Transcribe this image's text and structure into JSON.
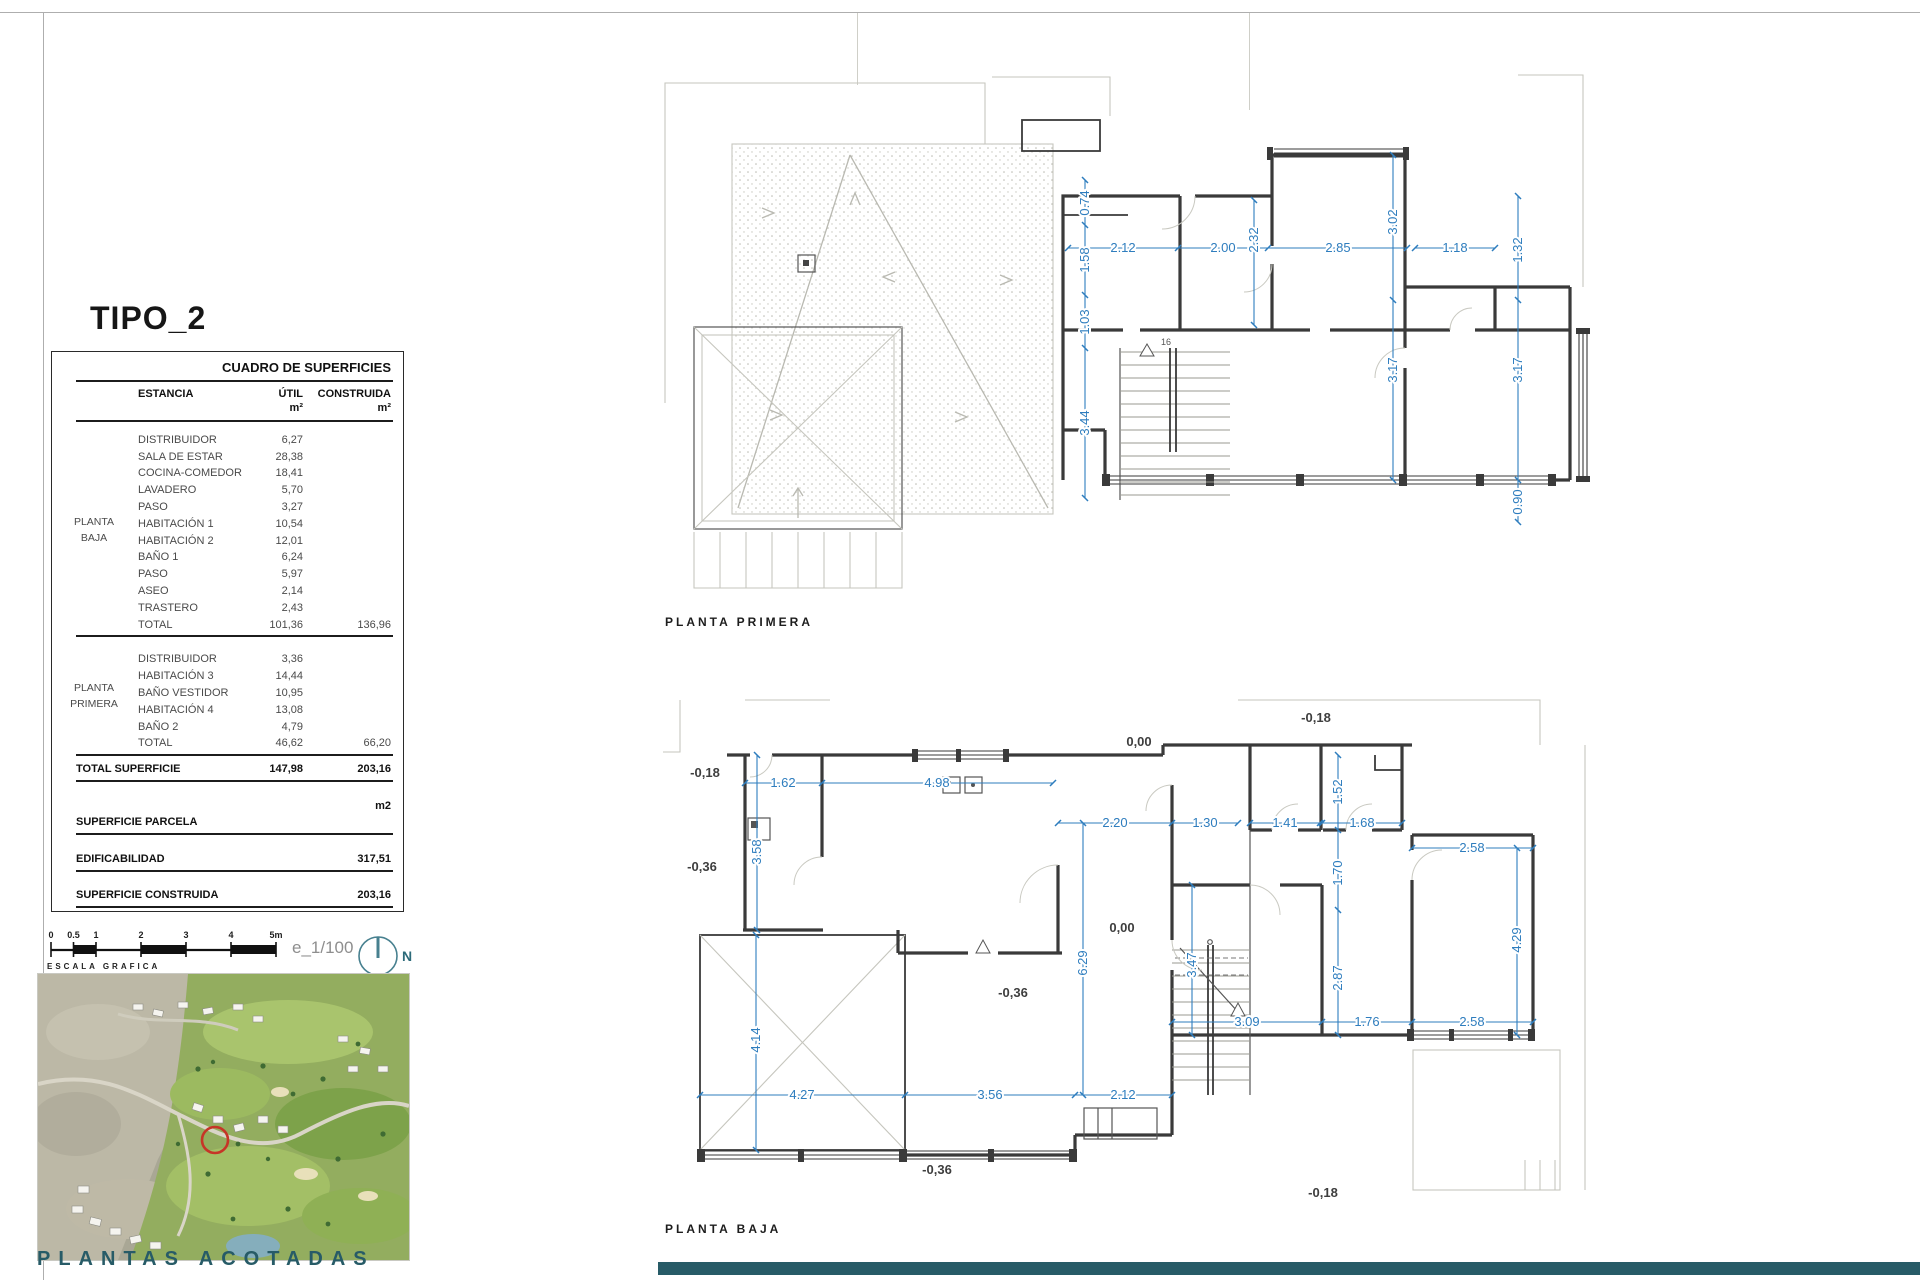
{
  "frame": {
    "title": "TIPO_2",
    "footer": "PLANTAS ACOTADAS"
  },
  "table": {
    "title": "CUADRO DE SUPERFICIES",
    "col_estancia": "ESTANCIA",
    "col_util": "ÚTIL",
    "col_construida": "CONSTRUIDA",
    "unit_util": "m²",
    "unit_construida": "m²",
    "pb": {
      "group": "PLANTA BAJA",
      "rows": [
        {
          "n": "DISTRIBUIDOR",
          "u": "6,27"
        },
        {
          "n": "SALA DE ESTAR",
          "u": "28,38"
        },
        {
          "n": "COCINA-COMEDOR",
          "u": "18,41"
        },
        {
          "n": "LAVADERO",
          "u": "5,70"
        },
        {
          "n": "PASO",
          "u": "3,27"
        },
        {
          "n": "HABITACIÓN 1",
          "u": "10,54"
        },
        {
          "n": "HABITACIÓN 2",
          "u": "12,01"
        },
        {
          "n": "BAÑO 1",
          "u": "6,24"
        },
        {
          "n": "PASO",
          "u": "5,97"
        },
        {
          "n": "ASEO",
          "u": "2,14"
        },
        {
          "n": "TRASTERO",
          "u": "2,43"
        }
      ],
      "total": {
        "n": "TOTAL",
        "u": "101,36",
        "c": "136,96"
      }
    },
    "pp": {
      "group": "PLANTA PRIMERA",
      "rows": [
        {
          "n": "DISTRIBUIDOR",
          "u": "3,36"
        },
        {
          "n": "HABITACIÓN 3",
          "u": "14,44"
        },
        {
          "n": "BAÑO VESTIDOR",
          "u": "10,95"
        },
        {
          "n": "HABITACIÓN 4",
          "u": "13,08"
        },
        {
          "n": "BAÑO 2",
          "u": "4,79"
        }
      ],
      "total": {
        "n": "TOTAL",
        "u": "46,62",
        "c": "66,20"
      }
    },
    "total_superficie": {
      "n": "TOTAL SUPERFICIE",
      "u": "147,98",
      "c": "203,16"
    },
    "unit_note": "m2",
    "parcela_label": "SUPERFICIE PARCELA",
    "edificabilidad": {
      "n": "EDIFICABILIDAD",
      "c": "317,51"
    },
    "sup_construida": {
      "n": "SUPERFICIE CONSTRUIDA",
      "c": "203,16"
    }
  },
  "scale": {
    "ticks": [
      "0",
      "0.5",
      "1",
      "2",
      "3",
      "4",
      "5m"
    ],
    "caption": "ESCALA GRAFICA",
    "ratio": "e_1/100",
    "north": "N"
  },
  "plans": {
    "pp": {
      "label": "PLANTA PRIMERA",
      "dims": [
        "2.12",
        "2.00",
        "2.32",
        "2.85",
        "3.02",
        "1.18",
        "1.32",
        "0.74",
        "1.58",
        "1.03",
        "3.44",
        "3.17",
        "3.17",
        "0.90",
        "16"
      ]
    },
    "pb": {
      "label": "PLANTA BAJA",
      "dims": [
        "1.62",
        "4.98",
        "3.58",
        "2.20",
        "1.30",
        "1.41",
        "1.68",
        "1.52",
        "1.70",
        "2.58",
        "6.29",
        "3.47",
        "2.87",
        "4.29",
        "4.14",
        "3.09",
        "1.76",
        "2.58",
        "4.27",
        "3.56",
        "2.12"
      ],
      "levels": [
        "-0,18",
        "-0,36",
        "0,00",
        "-0,18",
        "0,00",
        "-0,36",
        "-0,36",
        "-0,18"
      ]
    }
  },
  "colors": {
    "dim_blue": "#2e7dbe",
    "wall": "#3a3a3a",
    "teal": "#275b67",
    "marker_red": "#c63527"
  }
}
